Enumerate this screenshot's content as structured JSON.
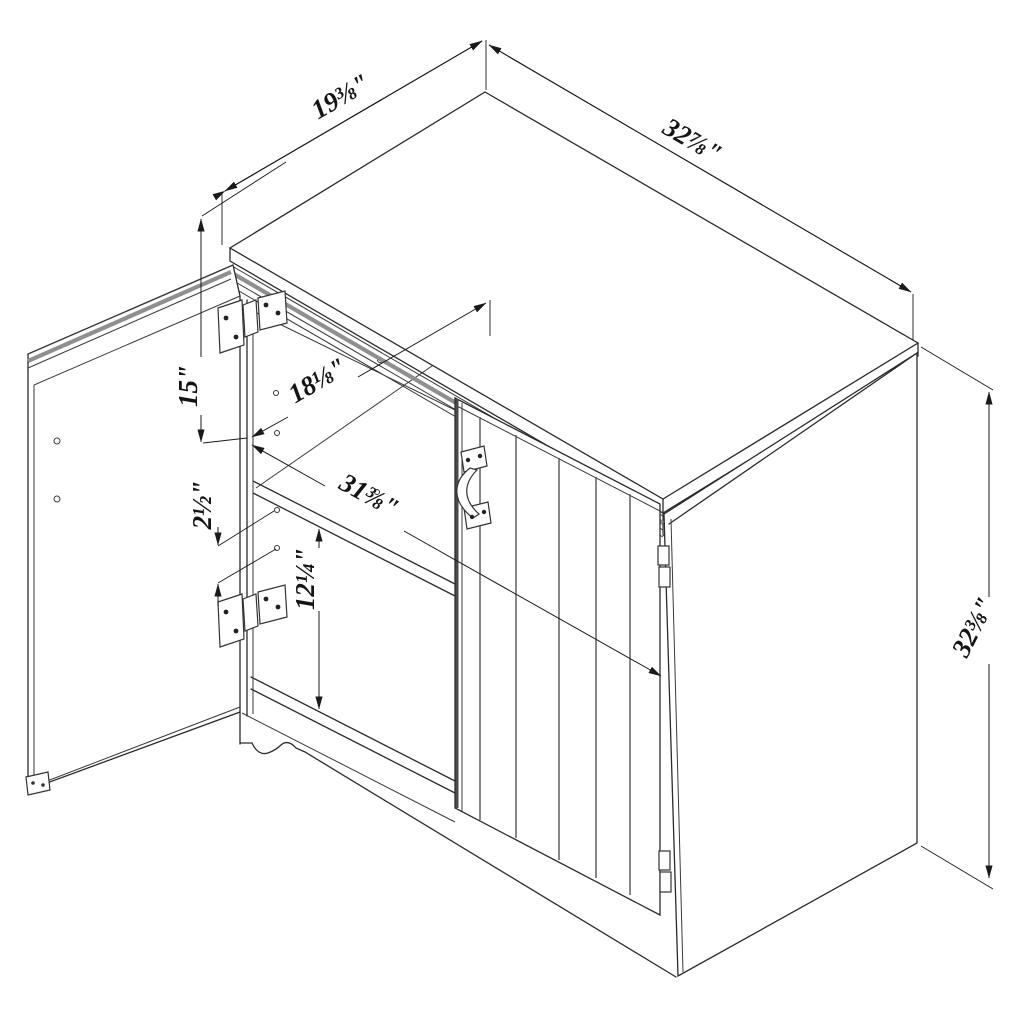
{
  "drawing": {
    "type": "isometric-dimension-diagram",
    "product": "two-door storage cabinet, left door open, right door with plank grooves and metal pull",
    "background": "#ffffff",
    "line_color": "#2b2b2b",
    "dimensions": {
      "top_depth": "19⅜\"",
      "top_width": "32⅞\"",
      "door_top_height": "15\"",
      "interior_depth": "18⅛\"",
      "pin_hole_spacing": "2½\"",
      "shelf_clearance": "12¼\"",
      "interior_width": "31⅜\"",
      "overall_height": "32⅜\""
    }
  }
}
